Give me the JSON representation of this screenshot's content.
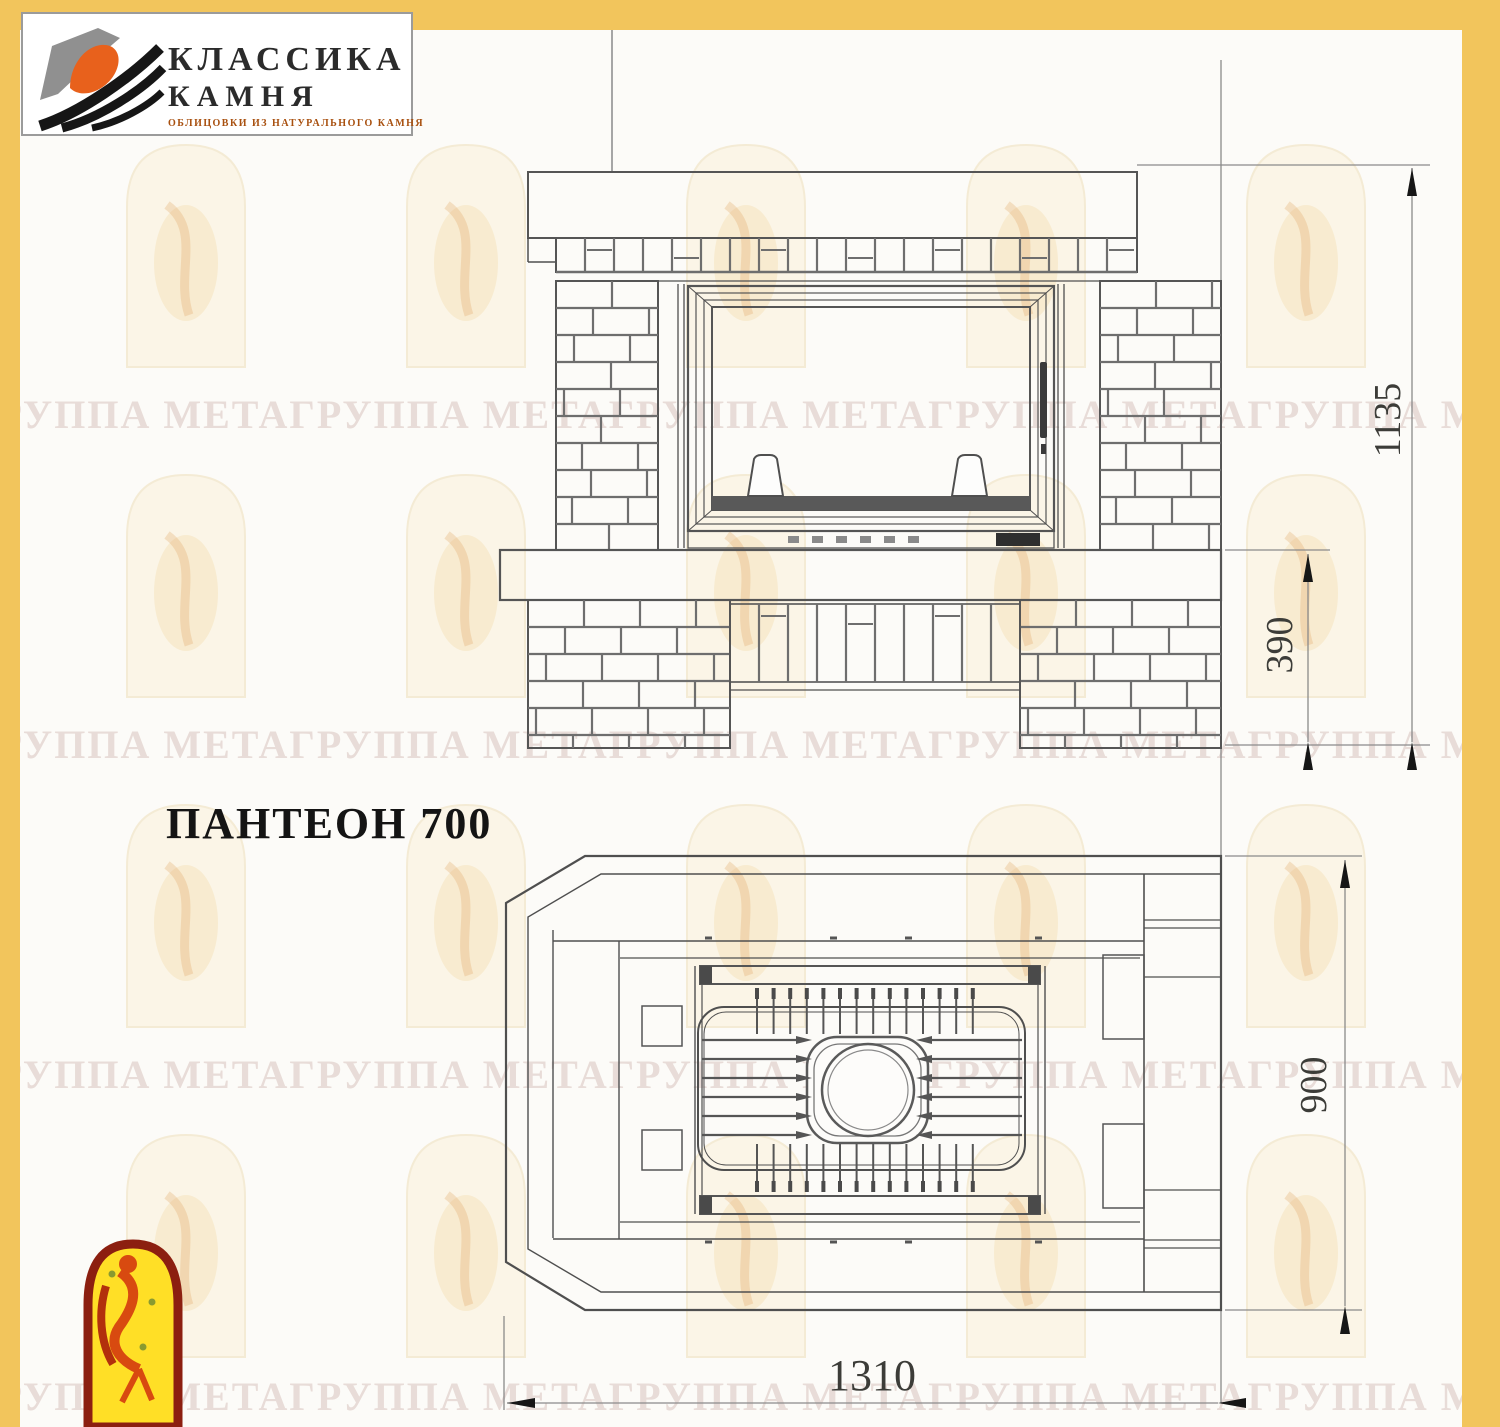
{
  "header_logo": {
    "line1": "КЛАССИКА",
    "line2": "КАМНЯ",
    "subtitle": "ОБЛИЦОВКИ ИЗ НАТУРАЛЬНОГО КАМНЯ"
  },
  "title": "ПАНТЕОН 700",
  "dimensions": {
    "overall_height": "1135",
    "plinth_height": "390",
    "depth": "900",
    "width": "1310"
  },
  "watermark": {
    "row_text": "ГРУППА МЕТАГРУППА МЕТАГРУППА МЕТАГРУППА МЕТАГРУППА МЕТАГРУППА МЕТА"
  },
  "colors": {
    "border_yellow": "#F2C55C",
    "logo_orange": "#E8611C",
    "logo_gray": "#909090",
    "logo_black": "#161616",
    "stamp_border_red": "#8C1F10",
    "stamp_yellow": "#FFDF26",
    "stamp_figure_orange": "#D84A10",
    "drawing_line": "#5A5A5A",
    "watermark_cream": "#FBF3DF",
    "watermark_text_pink": "#D9C4BE"
  }
}
